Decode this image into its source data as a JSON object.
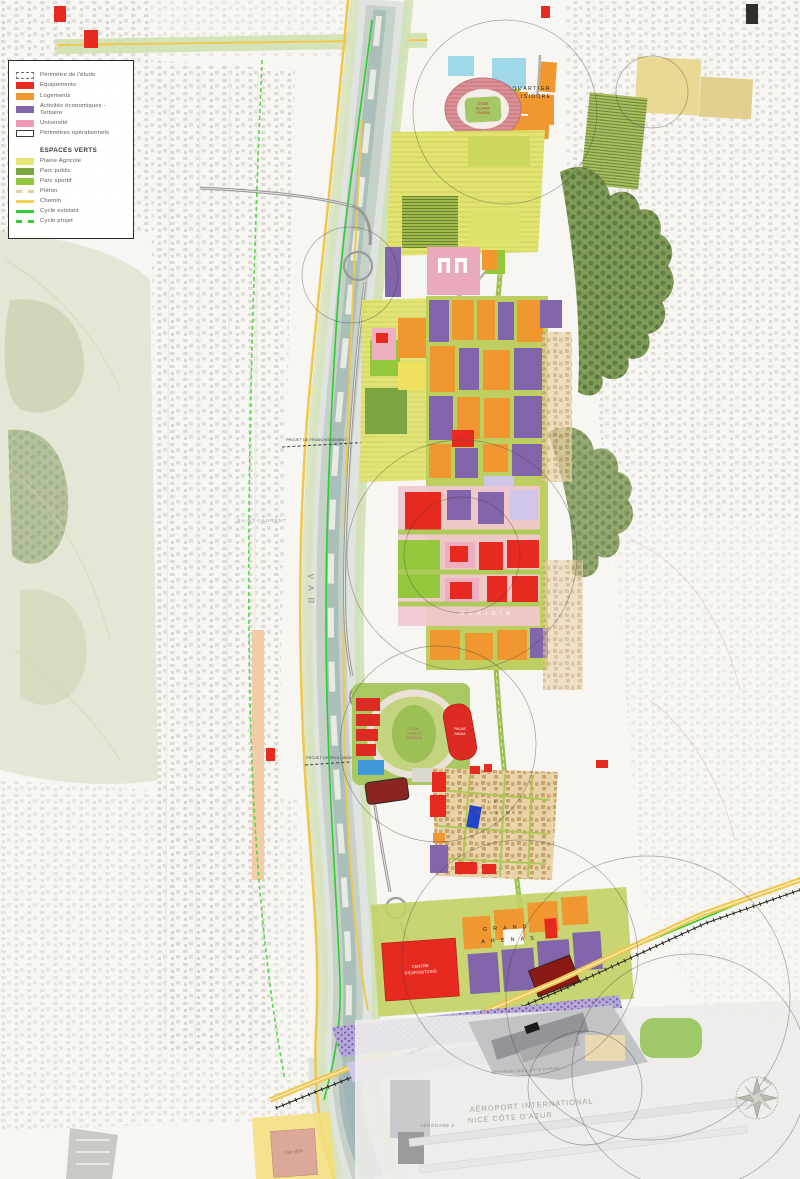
{
  "legend": {
    "items": [
      {
        "label": "Périmètre de l'étude",
        "type": "dashed-outline",
        "color": "#6a6a6a"
      },
      {
        "label": "Équipements",
        "type": "rect",
        "color": "#e62a20"
      },
      {
        "label": "Logements",
        "type": "rect",
        "color": "#f0972f"
      },
      {
        "label": "Activités économiques - Tertiaire",
        "type": "rect",
        "color": "#8365ab"
      },
      {
        "label": "Université",
        "type": "rect",
        "color": "#f09ab5"
      },
      {
        "label": "Périmètres opérationnels",
        "type": "outline",
        "color": "#3a3a3a"
      }
    ],
    "section_title": "ESPACES VERTS",
    "espaces_verts": [
      {
        "label": "Plaine Agricole",
        "type": "rect",
        "color": "#e4e576"
      },
      {
        "label": "Parc public",
        "type": "rect",
        "color": "#7ba442"
      },
      {
        "label": "Parc sportif",
        "type": "rect",
        "color": "#93c83d"
      },
      {
        "label": "Piéton",
        "type": "dashed-line",
        "color": "#e7cfa4"
      },
      {
        "label": "Chemin",
        "type": "line",
        "color": "#f3cf55"
      },
      {
        "label": "Cycle existant",
        "type": "line",
        "color": "#33cc33"
      },
      {
        "label": "Cycle projet",
        "type": "dashed-line",
        "color": "#33cc33"
      }
    ]
  },
  "labels": {
    "ecoquartier": [
      "ECOQUARTIER",
      "SAINT ISIDORE"
    ],
    "stade_allianz": [
      "STADE",
      "ALLIANZ",
      "RIVIERA"
    ],
    "var_river": "VAR",
    "franchissement": "PROJET DE FRANCHISSEMENT",
    "prolongement": "PROJET DE PROLONGEMENT T3",
    "saint_laurent": "SAINT-LAURENT",
    "meridia": "MERIDIA",
    "stade_charles": [
      "STADE",
      "CHARLES",
      "EHRMANN"
    ],
    "palais_nikaia": [
      "PALAIS",
      "NIKAIA"
    ],
    "les_moulins": [
      "LES",
      "MOULINS"
    ],
    "grand_arenas": [
      "GRAND",
      "ARENAS"
    ],
    "centre_expositions": [
      "CENTRE",
      "D'EXPOSITIONS"
    ],
    "parc_b": "PARC B",
    "aeroport_road": "AÉROPORT NICE-CÔTE D'AZUR",
    "aerogare2": "AÉROGARE 2",
    "airport": [
      "AÉROPORT INTERNATIONAL",
      "NICE CÔTE D'AZUR"
    ],
    "cap3000": "Cap 3000",
    "nord": "Nord"
  }
}
